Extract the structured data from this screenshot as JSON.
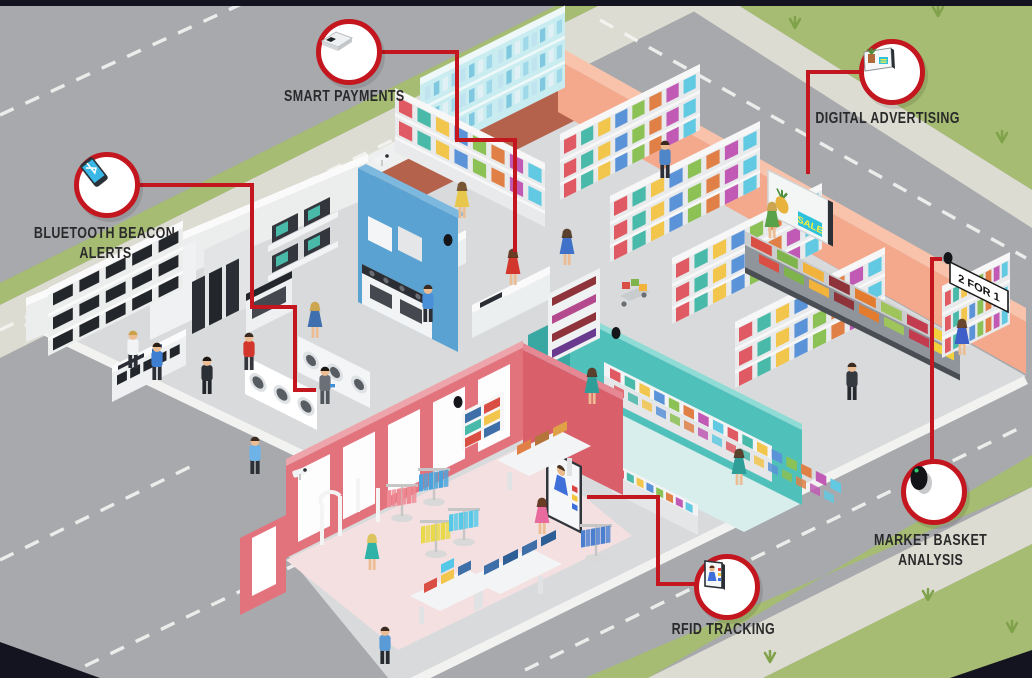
{
  "callouts": {
    "smart_payments": {
      "label": "SMART PAYMENTS",
      "icon": "payment-terminal-icon"
    },
    "digital_advertising": {
      "label": "DIGITAL ADVERTISING",
      "icon": "ad-display-icon"
    },
    "bluetooth_beacon": {
      "label_line1": "BLUETOOTH BEACON",
      "label_line2": "ALERTS",
      "icon": "smartphone-bluetooth-icon"
    },
    "market_basket": {
      "label_line1": "MARKET BASKET",
      "label_line2": "ANALYSIS",
      "icon": "security-camera-icon"
    },
    "rfid_tracking": {
      "label": "RFID TRACKING",
      "icon": "smart-mirror-icon"
    }
  },
  "signs": {
    "sale": "SALE",
    "two_for_one": "2 FOR 1"
  },
  "colors": {
    "accent_red": "#c3161f",
    "road": "#a7a9ac",
    "grass": "#a5bc72",
    "sidewalk": "#dcdcd2",
    "wall_salmon": "#f4a88c",
    "wall_blue": "#5aa2d2",
    "wall_pink": "#e2737d",
    "wall_pink_dark": "#d95f6b",
    "wall_teal": "#4fc0ba",
    "floor_gray": "#d9dadc",
    "floor_pink": "#f4e0e1",
    "floor_teal": "#d8eeec",
    "floor_brick": "#b5624c",
    "label_text": "#2a2a2b"
  }
}
